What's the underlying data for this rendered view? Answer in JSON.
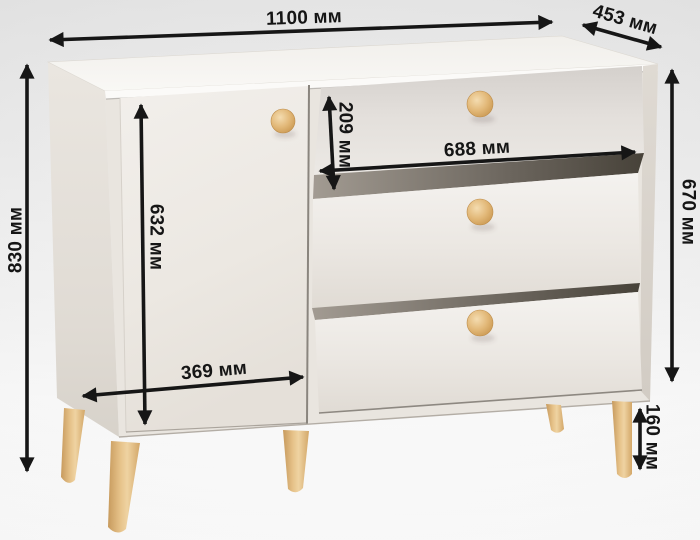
{
  "figure": {
    "subject": "chest-of-drawers-dimension-diagram",
    "units": "мм"
  },
  "dimensions": {
    "overall_width": "1100 мм",
    "depth": "453 мм",
    "overall_height": "830 мм",
    "front_height": "670 мм",
    "top_drawer_height": "209 мм",
    "drawer_width": "688 мм",
    "door_height": "632 мм",
    "door_width": "369 мм",
    "leg_height": "160 мм"
  },
  "colors": {
    "dimension_lines": "#161616",
    "cabinet_front": "#eeebe6",
    "cabinet_side": "#e4dfd8",
    "cabinet_top": "#f7f5f2",
    "wood_accent": "#e0b77c",
    "background_top": "#e7e7e7",
    "background_bottom": "#ffffff"
  }
}
